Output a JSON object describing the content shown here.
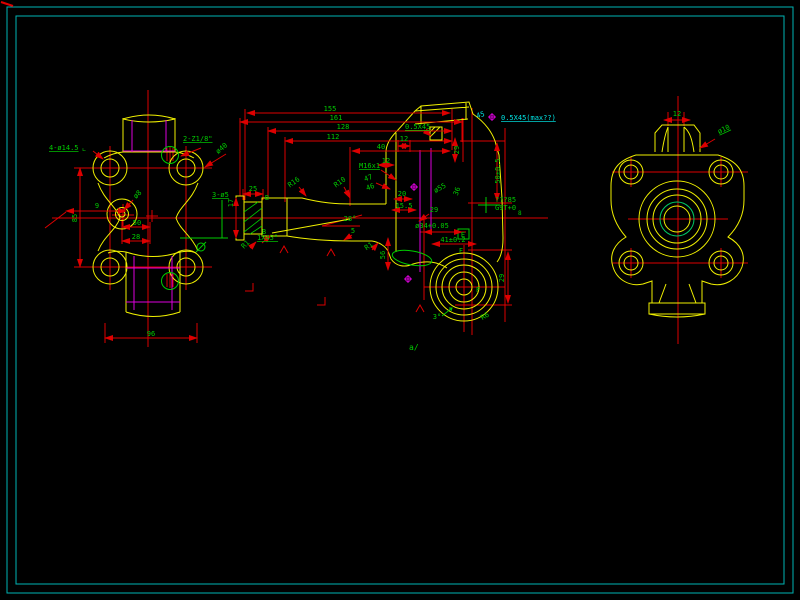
{
  "colors": {
    "background": "#000000",
    "frame": "#00b3b3",
    "part": "#f0f000",
    "dim": "#dd0000",
    "text": "#00cc00",
    "hidden": "#dd00dd",
    "note": "#00e5e5"
  },
  "annotations": [
    {
      "text": "4-ø14.5",
      "x": 49,
      "y": 150,
      "anchor": "start",
      "underline": true
    },
    {
      "text": "∟",
      "x": 84,
      "y": 152,
      "size": 6
    },
    {
      "text": "2-Z1/8\"",
      "x": 183,
      "y": 141,
      "anchor": "start",
      "underline": true
    },
    {
      "text": "ø40",
      "x": 223,
      "y": 150,
      "rot": -40
    },
    {
      "text": "9",
      "x": 97,
      "y": 208
    },
    {
      "text": "85",
      "x": 77,
      "y": 218,
      "rot": -90
    },
    {
      "text": "ø8",
      "x": 139,
      "y": 196,
      "rot": -45
    },
    {
      "text": "50",
      "x": 137,
      "y": 225
    },
    {
      "text": "28",
      "x": 136,
      "y": 239
    },
    {
      "text": "96",
      "x": 151,
      "y": 336
    },
    {
      "text": "3-ø5",
      "x": 212,
      "y": 197,
      "anchor": "start",
      "underline": true
    },
    {
      "text": "155",
      "x": 330,
      "y": 111
    },
    {
      "text": "161",
      "x": 336,
      "y": 120
    },
    {
      "text": "128",
      "x": 343,
      "y": 129
    },
    {
      "text": "112",
      "x": 333,
      "y": 139
    },
    {
      "text": "40",
      "x": 381,
      "y": 149
    },
    {
      "text": "12",
      "x": 404,
      "y": 141
    },
    {
      "text": "12",
      "x": 386,
      "y": 163
    },
    {
      "text": "25",
      "x": 253,
      "y": 191
    },
    {
      "text": "17",
      "x": 233,
      "y": 203,
      "rot": -90
    },
    {
      "text": "B",
      "x": 267,
      "y": 200
    },
    {
      "text": "B",
      "x": 264,
      "y": 234
    },
    {
      "text": "M16x1",
      "x": 359,
      "y": 168,
      "anchor": "start",
      "underline": true
    },
    {
      "text": "47",
      "x": 369,
      "y": 180,
      "rot": -20
    },
    {
      "text": "46",
      "x": 371,
      "y": 189,
      "rot": -20
    },
    {
      "text": "R16",
      "x": 295,
      "y": 184,
      "rot": -35
    },
    {
      "text": "R10",
      "x": 341,
      "y": 184,
      "rot": -35
    },
    {
      "text": "0.5X45",
      "x": 405,
      "y": 129,
      "anchor": "start",
      "underline": true
    },
    {
      "text": "45",
      "x": 481,
      "y": 117,
      "color": "#00e5e5",
      "rot": -15
    },
    {
      "text": "0.5X45(max??)",
      "x": 501,
      "y": 120,
      "color": "#00e5e5",
      "anchor": "start",
      "underline": true
    },
    {
      "text": "29",
      "x": 459,
      "y": 150,
      "rot": -90
    },
    {
      "text": "50±0.5",
      "x": 500,
      "y": 171,
      "rot": -90
    },
    {
      "text": "ø55",
      "x": 441,
      "y": 190,
      "rot": -30
    },
    {
      "text": "36",
      "x": 459,
      "y": 192,
      "rot": -70
    },
    {
      "text": "20",
      "x": 402,
      "y": 196
    },
    {
      "text": "15.5",
      "x": 404,
      "y": 208
    },
    {
      "text": "29",
      "x": 434,
      "y": 212
    },
    {
      "text": "ø34+0.05",
      "x": 432,
      "y": 228
    },
    {
      "text": "41±0.2",
      "x": 453,
      "y": 242
    },
    {
      "text": "E",
      "x": 463,
      "y": 237
    },
    {
      "text": "F",
      "x": 461,
      "y": 253
    },
    {
      "text": "F",
      "x": 478,
      "y": 292
    },
    {
      "text": "28°",
      "x": 350,
      "y": 221
    },
    {
      "text": "5",
      "x": 353,
      "y": 233
    },
    {
      "text": "1X45°",
      "x": 257,
      "y": 240,
      "anchor": "start",
      "underline": true
    },
    {
      "text": "R1",
      "x": 370,
      "y": 248,
      "rot": -35
    },
    {
      "text": "R1",
      "x": 247,
      "y": 246,
      "rot": -45
    },
    {
      "text": "3°",
      "x": 437,
      "y": 319
    },
    {
      "text": "R6",
      "x": 486,
      "y": 318,
      "rot": -30
    },
    {
      "text": "a/",
      "x": 409,
      "y": 350,
      "anchor": "start",
      "size": 8
    },
    {
      "text": "29",
      "x": 504,
      "y": 278,
      "rot": -90
    },
    {
      "text": "56",
      "x": 385,
      "y": 255,
      "rot": -90
    },
    {
      "text": "???85",
      "x": 495,
      "y": 202,
      "anchor": "start"
    },
    {
      "text": "G9T+0",
      "x": 495,
      "y": 210,
      "anchor": "start"
    },
    {
      "text": "8",
      "x": 518,
      "y": 215,
      "anchor": "start",
      "size": 6
    },
    {
      "text": "12",
      "x": 677,
      "y": 116
    },
    {
      "text": "ø10",
      "x": 719,
      "y": 134,
      "rot": -25,
      "anchor": "start",
      "underline": true
    }
  ]
}
